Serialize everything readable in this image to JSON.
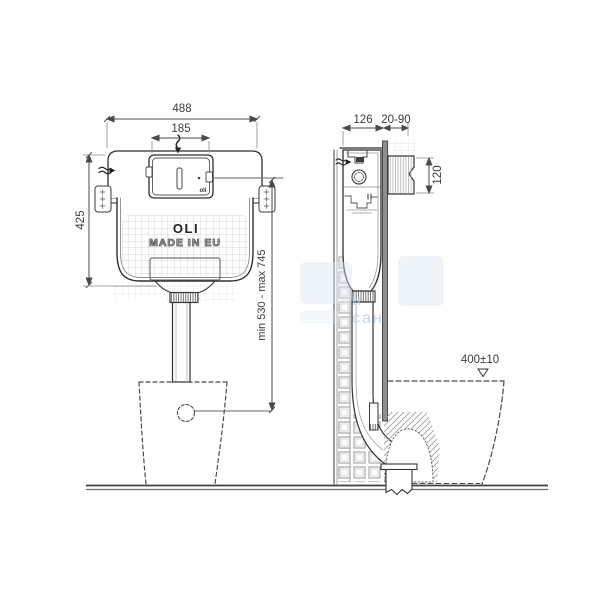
{
  "branding": {
    "logo": "OLI",
    "made_in": "MADE IN EU",
    "plate_logo": "oli"
  },
  "dimensions": {
    "front_width": "488",
    "plate_width": "185",
    "front_height": "425",
    "outlet_height_range": "min 530 - max 745",
    "depth": "126",
    "wall_thickness_range": "20-90",
    "sleeve_height": "120",
    "bowl_rim_height": "400±10"
  },
  "watermark": "н сан"
}
